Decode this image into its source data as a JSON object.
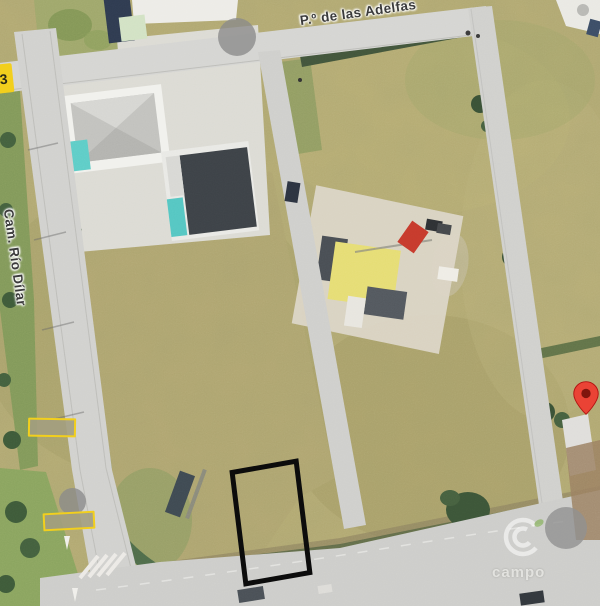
{
  "map": {
    "view_type": "satellite",
    "streets": [
      {
        "label": "P.º de las Adelfas"
      },
      {
        "label": "Cam. Río Dílar"
      }
    ],
    "marker": {
      "name": "red-location-pin",
      "color": "#EA4335"
    },
    "plot_highlight": {
      "name": "black-outlined-plot",
      "color": "#0C0C0C"
    },
    "redactions": {
      "count": 2,
      "border_color": "#F2CF1D"
    },
    "edge_sign": {
      "text": "3",
      "color": "#F2CF1D"
    },
    "watermark": {
      "text": "campo",
      "logo": "c-rings-with-leaf-logo"
    }
  }
}
